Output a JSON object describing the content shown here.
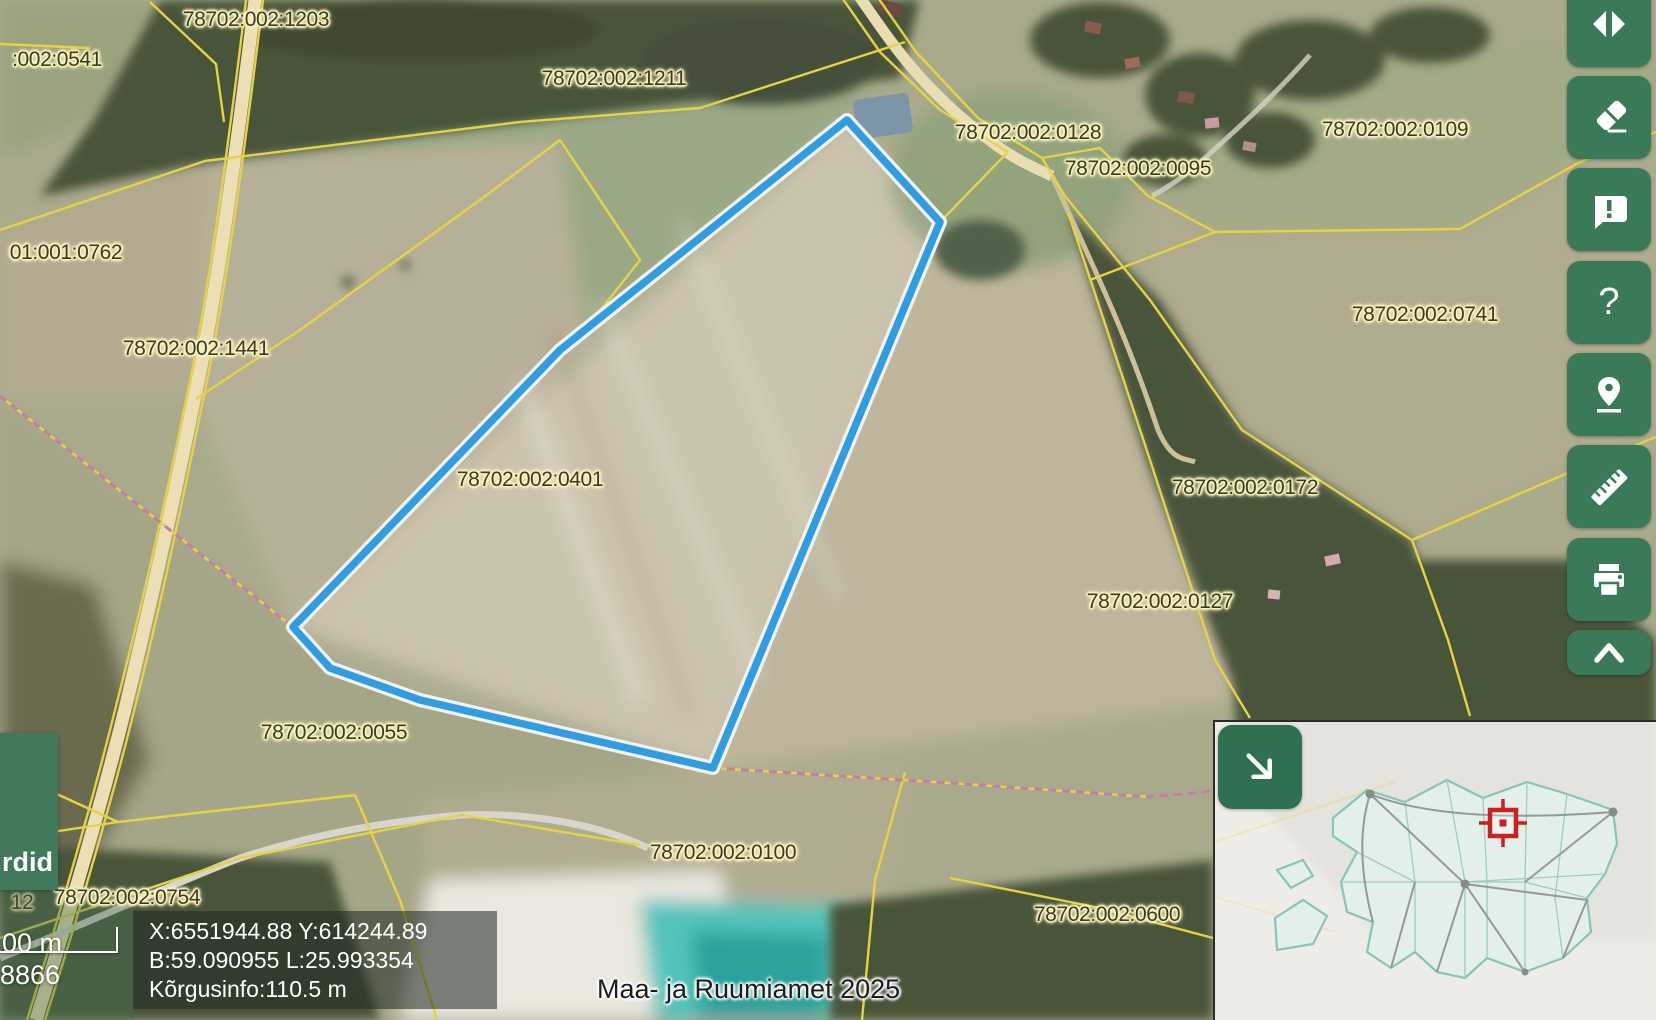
{
  "map": {
    "selected_parcel": "78702:002:0401",
    "attribution": "Maa- ja Ruumiamet 2025",
    "parcel_labels": [
      {
        "text": "78702:002:1203",
        "x": 256,
        "y": 20
      },
      {
        "text": ":002:0541",
        "x": 57,
        "y": 60
      },
      {
        "text": "78702:002:1211",
        "x": 614,
        "y": 79
      },
      {
        "text": "78702:002:0128",
        "x": 1028,
        "y": 133
      },
      {
        "text": "78702:002:0095",
        "x": 1138,
        "y": 169
      },
      {
        "text": "78702:002:0109",
        "x": 1395,
        "y": 130
      },
      {
        "text": "01:001:0762",
        "x": 66,
        "y": 253
      },
      {
        "text": "78702:002:0741",
        "x": 1425,
        "y": 315
      },
      {
        "text": "78702:002:1441",
        "x": 196,
        "y": 349
      },
      {
        "text": "78702:002:0401",
        "x": 530,
        "y": 480
      },
      {
        "text": "78702:002:0172",
        "x": 1245,
        "y": 488
      },
      {
        "text": "78702:002:0127",
        "x": 1160,
        "y": 602
      },
      {
        "text": "78702:002:0055",
        "x": 334,
        "y": 733
      },
      {
        "text": "78702:002:0100",
        "x": 723,
        "y": 853
      },
      {
        "text": "78702:002:0600",
        "x": 1107,
        "y": 915
      },
      {
        "text": "78702:002:0754",
        "x": 127,
        "y": 898
      },
      {
        "text": "12",
        "x": 22,
        "y": 903,
        "partial": true
      }
    ]
  },
  "info_panel": {
    "line1": "X:6551944.88 Y:614244.89",
    "line2": "B:59.090955 L:25.993354",
    "line3": "Kõrgusinfo:110.5 m"
  },
  "scale_bar": {
    "distance_partial": "00 m",
    "ratio_partial": "8866"
  },
  "side_panel": {
    "label_partial": "rdid"
  },
  "toolbar": {
    "help_glyph": "?",
    "buttons": [
      {
        "name": "layer-compare"
      },
      {
        "name": "clear-eraser"
      },
      {
        "name": "feedback"
      },
      {
        "name": "help"
      },
      {
        "name": "locate"
      },
      {
        "name": "measure"
      },
      {
        "name": "print"
      },
      {
        "name": "collapse-toolbar"
      }
    ]
  },
  "minimap": {
    "button_icon": "arrow-down-right",
    "marker_color": "#cc2020"
  },
  "colors": {
    "toolbar_green": "#3b7a58",
    "boundary_yellow": "#e6d243",
    "selection_blue": "#2f9de2",
    "pink_line": "#c87da6",
    "label_halo": "#f9f2bc"
  }
}
